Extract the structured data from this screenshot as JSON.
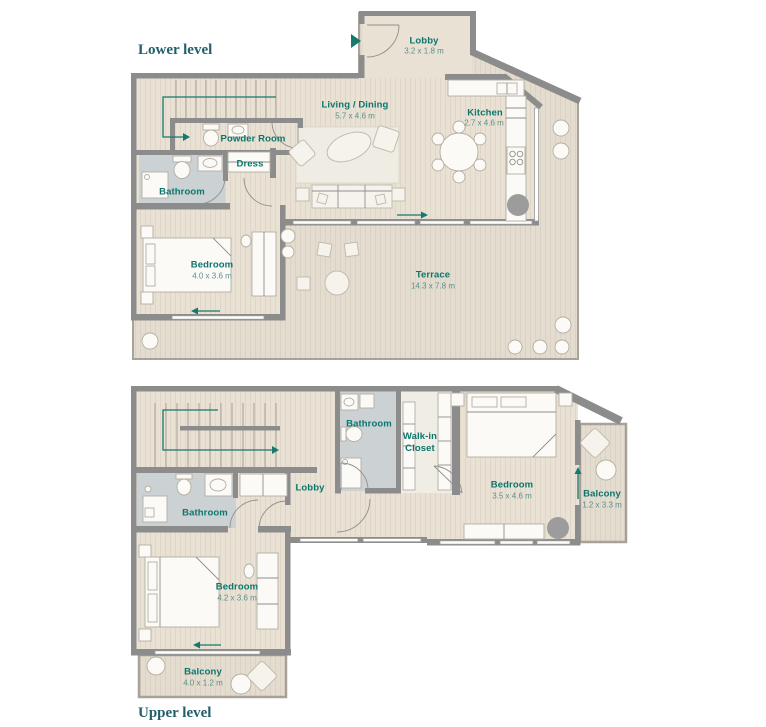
{
  "colors": {
    "wall": "#8c8c8c",
    "floor": "#e8e1d4",
    "terrace": "#e3dccf",
    "bathroom": "#ccd2d4",
    "rug": "#efece3",
    "label_teal": "#0b756d",
    "dims_teal": "#5c908b",
    "level_teal": "#235f6b",
    "arrow_teal": "#17786c",
    "column_gray": "#9c9c9c"
  },
  "lower": {
    "label": "Lower level",
    "lobby": {
      "name": "Lobby",
      "dims": "3.2 x 1.8 m"
    },
    "living": {
      "name": "Living / Dining",
      "dims": "5.7 x 4.6 m"
    },
    "kitchen": {
      "name": "Kitchen",
      "dims": "2.7 x 4.6 m"
    },
    "powder": {
      "name": "Powder Room"
    },
    "dress": {
      "name": "Dress"
    },
    "bathroom": {
      "name": "Bathroom"
    },
    "bedroom": {
      "name": "Bedroom",
      "dims": "4.0 x 3.6 m"
    },
    "terrace": {
      "name": "Terrace",
      "dims": "14.3 x 7.8 m"
    }
  },
  "upper": {
    "label": "Upper level",
    "bathroom_top": {
      "name": "Bathroom"
    },
    "walkin": {
      "name": "Walk-in Closet"
    },
    "lobby": {
      "name": "Lobby"
    },
    "bedroom_right": {
      "name": "Bedroom",
      "dims": "3.5 x 4.6 m"
    },
    "balcony_right": {
      "name": "Balcony",
      "dims": "1.2 x 3.3 m"
    },
    "bathroom_left": {
      "name": "Bathroom"
    },
    "bedroom_left": {
      "name": "Bedroom",
      "dims": "4.2 x 3.6 m"
    },
    "balcony_bottom": {
      "name": "Balcony",
      "dims": "4.0 x 1.2 m"
    }
  }
}
